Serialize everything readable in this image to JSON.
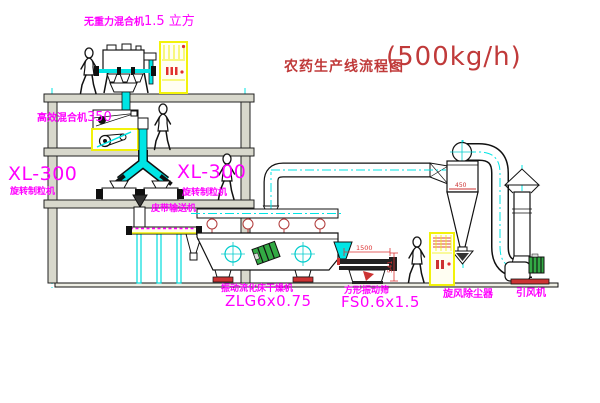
{
  "title": {
    "main": "农药生产线流程图",
    "capacity": "(500kg/h)"
  },
  "equipment": {
    "gravity_mixer": {
      "name": "无重力混合机",
      "spec": "1.5 立方"
    },
    "high_mixer": {
      "name": "高效混合机",
      "spec": "350"
    },
    "granulator_left": {
      "model": "XL-300",
      "name": "旋转制粒机"
    },
    "granulator_right": {
      "model": "XL-300",
      "name": "旋转制粒机"
    },
    "belt_conveyor": {
      "name": "皮带输送机"
    },
    "dryer": {
      "name": "振动流化床干燥机",
      "model": "ZLG6x0.75"
    },
    "sieve": {
      "name": "方形振动筛",
      "model": "FS0.6x1.5"
    },
    "cyclone": {
      "name": "旋风除尘器"
    },
    "fan": {
      "name": "引风机"
    }
  },
  "dimensions": {
    "sieve_length": "1500",
    "sieve_height": "541",
    "cyclone_note": "450"
  },
  "colors": {
    "label": "#ff00ff",
    "title": "#c03a3a",
    "centerline": "#00e5e5",
    "cabinet": "#f2f20a",
    "accent_red": "#cc3333",
    "motor_green": "#33aa44"
  }
}
